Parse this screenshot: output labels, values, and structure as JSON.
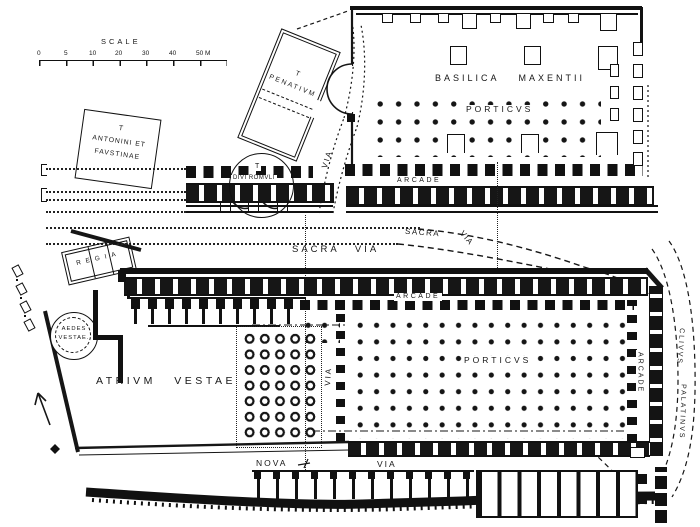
{
  "scale": {
    "label": "SCALE",
    "ticks": [
      "0",
      "5",
      "10",
      "20",
      "30",
      "40",
      "50 M"
    ]
  },
  "buildings": {
    "antoninus": {
      "l1": "T",
      "l2": "ANTONINI ET",
      "l3": "FAVSTINAE"
    },
    "penates": {
      "l1": "T",
      "l2": "PENATIVM"
    },
    "divi_romuli": {
      "l1": "T",
      "l2": "DIVI ROMVLI"
    },
    "basilica": {
      "name": "BASILICA MAXENTII"
    },
    "upper_porticus": {
      "name": "PORTICVS",
      "arcade": "ARCADE"
    },
    "regia": {
      "name": "REGIA"
    },
    "aedes": {
      "l1": "AEDES",
      "l2": "VESTAE."
    },
    "atrium": {
      "name": "ATRIVM VESTAE"
    },
    "lower_porticus": {
      "name": "PORTICVS",
      "arcade_top": "ARCADE",
      "arcade_right": "ARCADE"
    }
  },
  "roads": {
    "sacra_via": "SACRA VIA",
    "sacra_bend_a": "SACRA",
    "sacra_bend_b": "VIA",
    "via_upper": "VIA",
    "via_lower": "VIA",
    "nova": "NOVA",
    "nova_via": "VIA",
    "clivus_a": "CLIVVS",
    "clivus_b": "PALATINVS"
  },
  "colors": {
    "ink": "#161616",
    "paper": "#ffffff"
  }
}
